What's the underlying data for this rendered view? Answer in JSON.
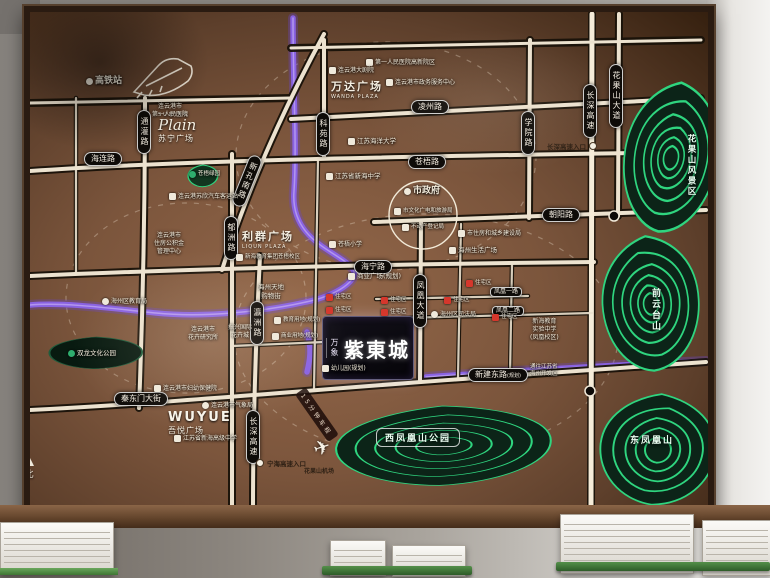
{
  "project": {
    "brand": "万象",
    "name": "紫東城"
  },
  "compass": "北",
  "ring_label": "15分钟车程",
  "roads": {
    "lingzhou": "凌州路",
    "hailian": "海连路",
    "cangwu": "苍梧路",
    "chaoyang": "朝阳路",
    "haining": "海宁路",
    "qindongmen": "秦东门大街",
    "xinjiandong": "新建东路",
    "guihua_suffix": "(规划)",
    "tongguan": "通灌路",
    "yuzhou": "郁洲路",
    "yingzhou": "瀛洲路",
    "keyuan": "科苑路",
    "xueyuan": "学院路",
    "changshen": "长深高速",
    "huaguoshan_ave": "花果山大道",
    "fenghuang_ave": "凤凰大道",
    "xinkong": "新孔南路",
    "fenghuang1": "凤凰一路",
    "fenghuang2": "凤凰二路"
  },
  "entrances": {
    "changshen": "长深高速入口",
    "ninghai": "宁海高速入口"
  },
  "transport": {
    "hsr": "高铁站",
    "bus": "连云港苏欣汽车客运站",
    "airport": "花果山机场"
  },
  "plazas": {
    "suning_en": "SUNING",
    "suning_script": "Plain",
    "suning_zh": "苏宁广场",
    "wanda_zh": "万达广场",
    "wanda_en": "WANDA PLAZA",
    "liqun_zh": "利群广场",
    "liqun_en": "LIQUN PLAZA",
    "wuyue_en": "WUYUE",
    "wuyue_zh": "吾悦广场",
    "shangye": "商业广场(规划)",
    "shenghuo": "海州生活广场",
    "tiandi1": "海州天地",
    "tiandi2": "购物街"
  },
  "government": {
    "city_hall": "市政府",
    "culture_bureau": "市文化广电和旅游局",
    "real_estate_reg": "不动产登记局",
    "construction_bureau": "市住房和城乡建设局",
    "service_center": "连云港市政务服务中心",
    "fund1": "连云港市",
    "fund2": "住房公积金",
    "fund3": "管理中心",
    "justice": "海州区司法局",
    "education_bureau": "海州区教育局",
    "maternity": "连云港市妇幼保健院",
    "weather": "连云港市气象局"
  },
  "schools": {
    "ocean_univ": "江苏海洋大学",
    "xinhai_middle": "江苏省新海中学",
    "cangwu_primary": "苍梧小学",
    "xinhai_group": "新海教育集团苍梧校区",
    "fh1": "新海教育",
    "fh2": "实验中学",
    "fh3": "(凤凰校区)",
    "xinhai_senior": "江苏省新海高级中学"
  },
  "hospitals": {
    "first1": "连云港市",
    "first2": "第一人民医院",
    "gaoxin": "第一人民医院高新院区"
  },
  "culture": {
    "theater": "连云港大剧院",
    "flower1": "连云港市",
    "flower2": "花卉研究所",
    "zhenxing1": "振兴国际",
    "zhenxing2": "花卉城",
    "wenhua_park": "双龙文化公园"
  },
  "planning": {
    "residential": "住宅区",
    "edu_land": "教育用地(规划)",
    "biz_land": "商业用地(规划)",
    "kindergarten": "幼儿园(规划)",
    "tongwang1": "通往江苏省",
    "tongwang2": "海州开发区"
  },
  "mountains": {
    "huaguoshan": "花果山风景区",
    "qianyuntai": "前云台山",
    "dongfenghuang": "东凤凰山",
    "xifenghuang": "西凤凰山公园",
    "cangwu_green": "苍梧绿园"
  },
  "colors": {
    "contour_green": "#2fd57f",
    "river_purple": "#8a63e8",
    "road_cream": "#ece2cf",
    "residential_red": "#d5372c",
    "map_brown": "#7a553d"
  }
}
